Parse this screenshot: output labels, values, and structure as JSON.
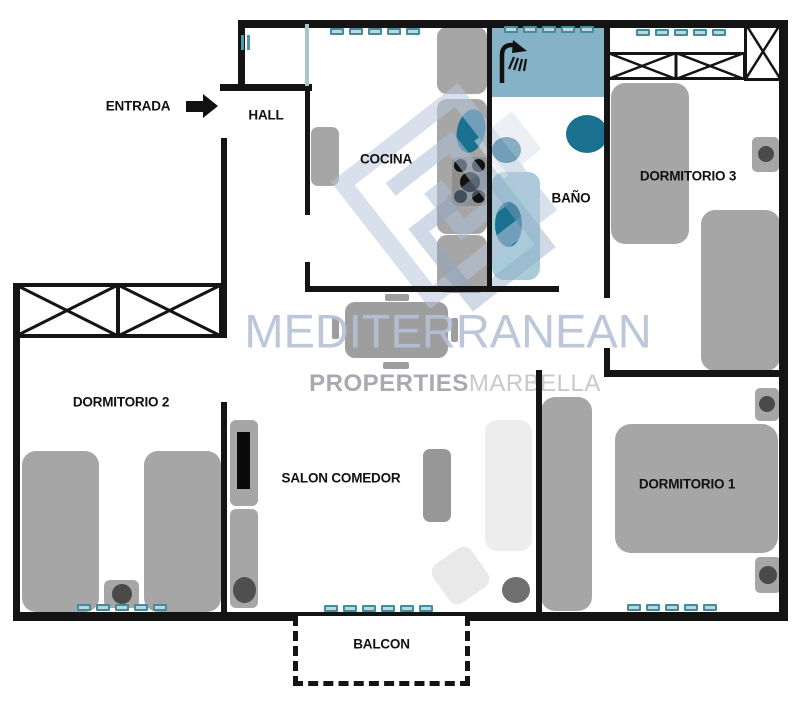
{
  "rooms": {
    "entrada": {
      "label": "ENTRADA"
    },
    "hall": {
      "label": "HALL"
    },
    "cocina": {
      "label": "COCINA"
    },
    "bano": {
      "label": "BAÑO"
    },
    "dormitorio3": {
      "label": "DORMITORIO 3"
    },
    "dormitorio2": {
      "label": "DORMITORIO 2"
    },
    "salon": {
      "label": "SALON COMEDOR"
    },
    "dormitorio1": {
      "label": "DORMITORIO 1"
    },
    "balcon": {
      "label": "BALCON"
    }
  },
  "watermark": {
    "brand": "MEDITERRANEAN",
    "sub_bold": "PROPERTIES",
    "sub_light": "MARBELLA"
  },
  "colors": {
    "wall": "#141414",
    "furniture_gray": "#a6a6a6",
    "shower_area_blue": "#85b2c6",
    "bathtub_blue": "#a7cbd9",
    "fixture_teal": "#19708f",
    "window_mark_teal": "#3f8d9e",
    "watermark_blue": "#b5c2d6",
    "watermark_gray": "#a7abb1"
  },
  "windows": [
    {
      "name": "window-cocina",
      "x": 330,
      "y": 28,
      "count": 5
    },
    {
      "name": "window-bano",
      "x": 504,
      "y": 26,
      "count": 5
    },
    {
      "name": "window-dorm3",
      "x": 636,
      "y": 29,
      "count": 5
    },
    {
      "name": "window-dorm2",
      "x": 77,
      "y": 604,
      "count": 5
    },
    {
      "name": "window-salon",
      "x": 324,
      "y": 605,
      "count": 6
    },
    {
      "name": "window-dorm1",
      "x": 627,
      "y": 604,
      "count": 5
    }
  ]
}
